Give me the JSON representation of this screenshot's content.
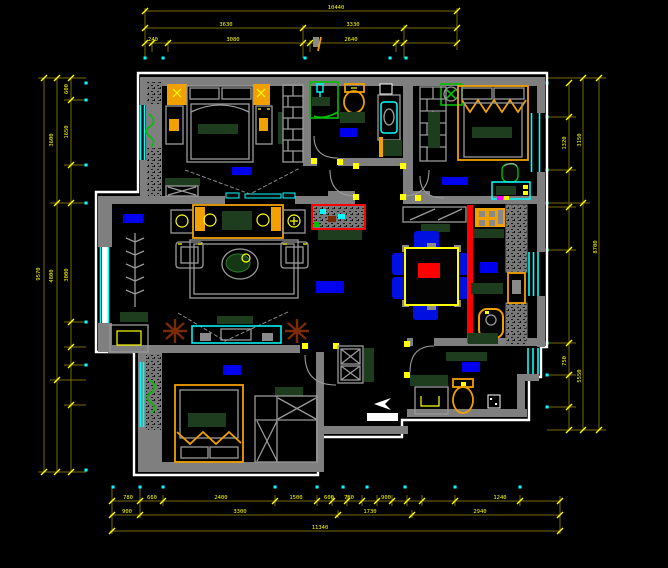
{
  "drawing": {
    "type": "apartment-floor-plan-cad",
    "background": "#000000",
    "labels_illegible_rendered_as_blocks": true
  },
  "colors": {
    "walls": "#7f7f7f",
    "outer_outline": "#ffffff",
    "dimension_lines": "#7a6a00",
    "dimension_text": "#ffff00",
    "windows": "#00ffff",
    "room_labels": "#0000f0",
    "furniture_accent": "#f0a000",
    "counter_tops": "#1e3c1e",
    "divider_bar": "#ff0000",
    "chairs": "#0010e0",
    "plants": "#00c000",
    "dry_plants": "#7a2a05",
    "axis_dots": "#00ffff"
  },
  "dimensions": {
    "top": {
      "overall": "10440",
      "row2": [
        "3630",
        "3330"
      ],
      "row3": [
        "240",
        "3080",
        "2640"
      ]
    },
    "bottom": {
      "row1": [
        "780",
        "660",
        "2400",
        "1500",
        "600",
        "780",
        "900",
        "1240"
      ],
      "row2": [
        "900",
        "3300",
        "1730",
        "2940"
      ],
      "overall": "11340"
    },
    "left": {
      "outer": "9570",
      "mid": [
        "3600",
        "4800"
      ],
      "inner": [
        "600",
        "1650",
        "3000"
      ]
    },
    "right": {
      "outer": "8700",
      "mid": [
        "3150",
        "5550"
      ],
      "inner": [
        "1320",
        "750"
      ]
    }
  },
  "rooms": [
    {
      "id": "bedroom-top-left",
      "label_block": "blue"
    },
    {
      "id": "bathroom-top",
      "label_block": "blue"
    },
    {
      "id": "bedroom-top-right",
      "label_block": "blue"
    },
    {
      "id": "living-room",
      "label_block": "blue"
    },
    {
      "id": "dining-room",
      "label_block": "blue"
    },
    {
      "id": "kitchen",
      "label_block": "blue"
    },
    {
      "id": "bedroom-bottom-left",
      "label_block": "blue"
    },
    {
      "id": "bathroom-bottom-right",
      "label_block": "blue"
    },
    {
      "id": "entry-foyer",
      "label_block": "white"
    }
  ]
}
